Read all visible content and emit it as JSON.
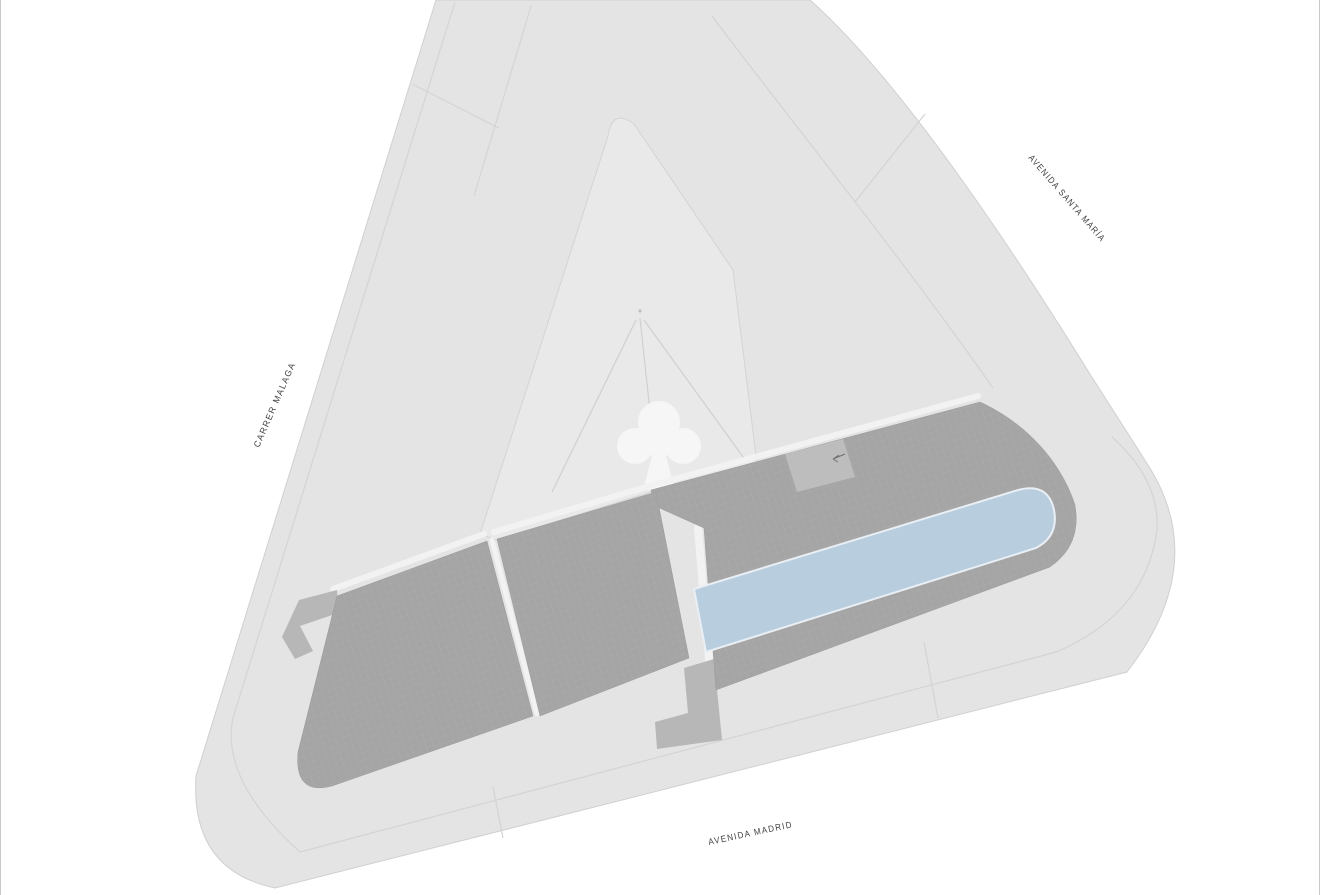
{
  "streets": [
    {
      "label": "AVENIDA SANTA MARÍA"
    },
    {
      "label": "CARRER MALAGA"
    },
    {
      "label": "AVENIDA MADRID"
    }
  ],
  "features": {
    "tree_icon": "tree-icon",
    "direction_arrow_icon": "arrow-icon"
  },
  "theme": {
    "background": "#ffffff",
    "block": "#e4e4e4",
    "courtyard": "#e9e9e9",
    "building": "#a5a5a5",
    "building_grid_line": "#b6b6b6",
    "ramp": "#b7b7b7",
    "pool": "#b8cede",
    "pool_edge": "#e9eff4",
    "kerb": "#f2f2f2",
    "hairline": "#d4d4d4",
    "block_edge": "#d0d0d0",
    "label": "#3f3f3f",
    "frame": "#c9c9c9",
    "tree": "#f6f6f6",
    "deck_structure": "#bdbdbd",
    "arrow": "#6f6f6f"
  }
}
